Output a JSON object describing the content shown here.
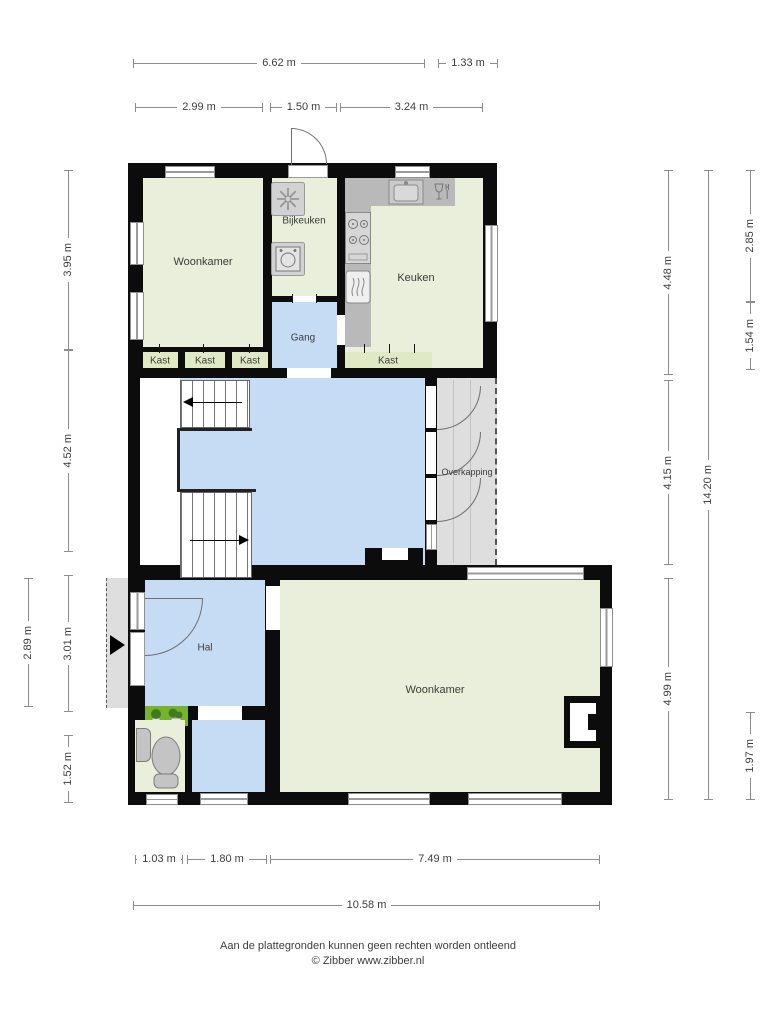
{
  "rooms": {
    "woonkamer_top": "Woonkamer",
    "bijkeuken": "Bijkeuken",
    "keuken": "Keuken",
    "gang": "Gang",
    "kast_1": "Kast",
    "kast_2": "Kast",
    "kast_3": "Kast",
    "kast_4": "Kast",
    "overkapping": "Overkapping",
    "hal": "Hal",
    "woonkamer_bottom": "Woonkamer"
  },
  "dimensions": {
    "top_total": "6.62 m",
    "top_overkapping": "1.33 m",
    "top_woonkamer": "2.99 m",
    "top_bijkeuken": "1.50 m",
    "top_keuken": "3.24 m",
    "left_upper": "3.95 m",
    "left_middle": "4.52 m",
    "left_hal": "3.01 m",
    "left_toilet": "1.52 m",
    "left_outer": "2.89 m",
    "right_upper": "4.48 m",
    "right_middle": "4.15 m",
    "right_lower": "4.99 m",
    "right_total": "14.20 m",
    "right_outer_upper": "2.85 m",
    "right_outer_mid": "1.54 m",
    "right_outer_lower": "1.97 m",
    "bottom_left": "1.03 m",
    "bottom_mid": "1.80 m",
    "bottom_right": "7.49 m",
    "bottom_total": "10.58 m"
  },
  "footer": {
    "disclaimer": "Aan de plattegronden kunnen geen rechten worden ontleend",
    "copyright": "© Zibber www.zibber.nl"
  },
  "icons": {
    "entrance": "arrow-right",
    "freezer": "snowflake",
    "washer": "washing-machine",
    "stove": "cooktop-four-burners",
    "dishwasher": "dishwasher",
    "sink": "kitchen-sink",
    "glassware": "glass-and-fork",
    "toilet": "toilet",
    "basin": "hand-basin",
    "plants": "shrubs",
    "stairs": "stair-direction-arrow"
  },
  "colors": {
    "wall": "#0c0c0c",
    "room_green": "#e9efda",
    "kast_green": "#dfe9c3",
    "room_blue": "#c6dcf4",
    "counter_gray": "#b9b9b9",
    "outdoor_gray": "#dedede",
    "plant_green": "#77b32f"
  }
}
